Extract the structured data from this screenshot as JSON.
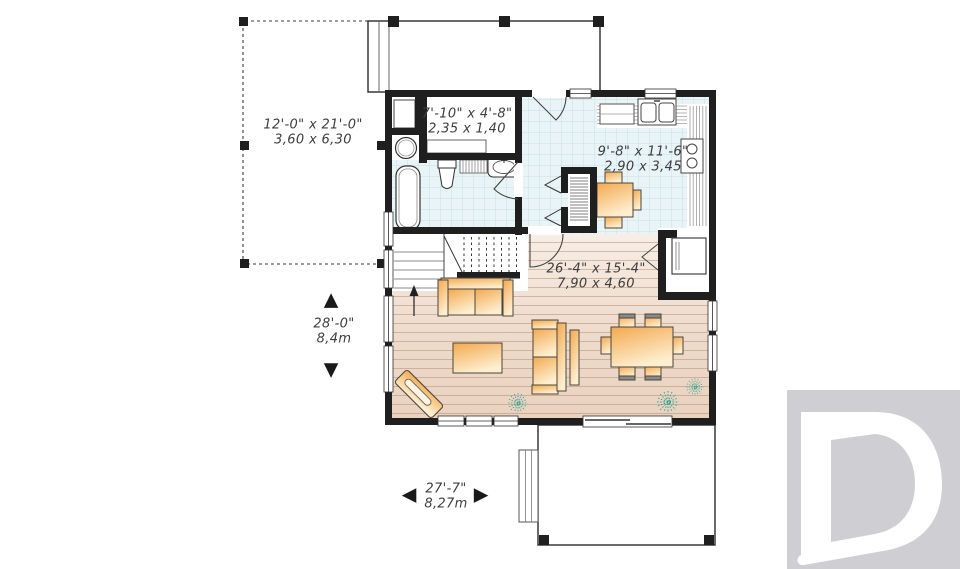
{
  "plan": {
    "rooms": {
      "deck": {
        "imperial": "12'-0\" x 21'-0\"",
        "metric": "3,60 x 6,30"
      },
      "bathroom_hall": {
        "imperial": "7'-10\" x 4'-8\"",
        "metric": "2,35 x 1,40"
      },
      "kitchen": {
        "imperial": "9'-8\" x 11'-6\"",
        "metric": "2,90 x 3,45"
      },
      "living_dining": {
        "imperial": "26'-4\" x 15'-4\"",
        "metric": "7,90 x 4,60"
      }
    },
    "overall": {
      "depth": {
        "imperial": "28'-0\"",
        "metric": "8,4m"
      },
      "width": {
        "imperial": "27'-7\"",
        "metric": "8,27m"
      }
    }
  },
  "icons": {
    "up_arrow": "▲",
    "down_arrow": "▼",
    "left_arrow": "◀",
    "right_arrow": "▶"
  },
  "logo": {
    "letter": "D"
  },
  "colors": {
    "wall": "#1f1f1f",
    "tile": "#e9f4f6",
    "tile_line": "#c6e0e4",
    "wood_light": "#f7eee6",
    "wood_dark": "#e9d2bf",
    "furniture_orange": "#f3a94f",
    "furniture_pale": "#fdeecf",
    "plant": "#2fa293",
    "logo_gray": "#cfcfd3",
    "dimension_text": "#3d3d3d"
  }
}
